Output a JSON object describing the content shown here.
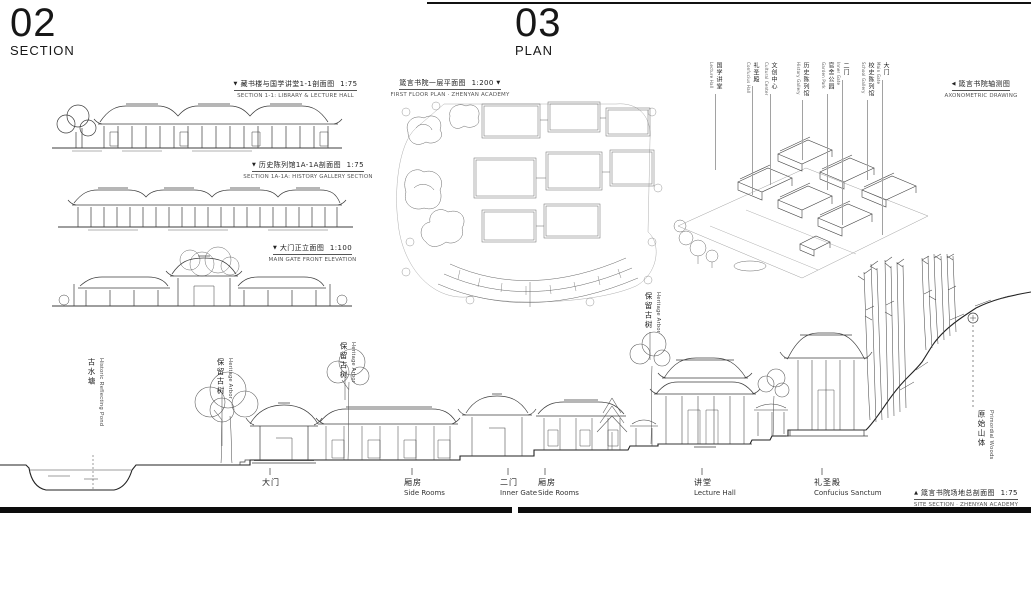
{
  "headers": {
    "section": {
      "number": "02",
      "label": "SECTION"
    },
    "plan": {
      "number": "03",
      "label": "PLAN"
    }
  },
  "markers": {
    "down": "▼",
    "left": "◀",
    "up": "▲"
  },
  "left_drawings": [
    {
      "title_zh": "藏书楼与国学讲堂1-1剖面图",
      "scale": "1:75",
      "title_en": "SECTION 1-1: LIBRARY & LECTURE HALL"
    },
    {
      "title_zh": "历史陈列馆1A-1A剖面图",
      "scale": "1:75",
      "title_en": "SECTION 1A-1A: HISTORY GALLERY SECTION"
    },
    {
      "title_zh": "大门正立面图",
      "scale": "1:100",
      "title_en": "MAIN GATE FRONT ELEVATION"
    }
  ],
  "floor_plan": {
    "title_zh": "箴言书院一层平面图",
    "scale": "1:200",
    "title_en": "FIRST FLOOR PLAN · ZHENYAN ACADEMY"
  },
  "axonometric": {
    "title_zh": "箴言书院轴测图",
    "title_en": "AXONOMETRIC DRAWING",
    "labels": [
      {
        "zh": "国学讲堂",
        "en": "Lecture Hall"
      },
      {
        "zh": "礼圣殿",
        "en": "Confucius Hall"
      },
      {
        "zh": "文创中心",
        "en": "Cultural Center"
      },
      {
        "zh": "历史陈列馆",
        "en": "History Gallery"
      },
      {
        "zh": "官舍公园",
        "en": "Garden Park"
      },
      {
        "zh": "二门",
        "en": "Inner Gate"
      },
      {
        "zh": "校史陈列馆",
        "en": "School Gallery"
      },
      {
        "zh": "大门",
        "en": "Main Gate"
      }
    ]
  },
  "site_section": {
    "tree_labels": [
      {
        "zh": "古水塘",
        "en": "Historic Reflecting Pond"
      },
      {
        "zh": "保留古树",
        "en": "Heritage Arbor"
      },
      {
        "zh": "保留古树",
        "en": "Heritage Arbor"
      },
      {
        "zh": "保留古树",
        "en": "Heritage Arbor"
      },
      {
        "zh": "原始山体",
        "en": "Primordial Woods"
      }
    ],
    "building_labels": [
      {
        "zh": "大门",
        "en": ""
      },
      {
        "zh": "厢房",
        "en": "Side Rooms"
      },
      {
        "zh": "二门",
        "en": "Inner Gate"
      },
      {
        "zh": "厢房",
        "en": "Side Rooms"
      },
      {
        "zh": "讲堂",
        "en": "Lecture Hall"
      },
      {
        "zh": "礼圣殿",
        "en": "Confucius Sanctum"
      }
    ],
    "caption": {
      "title_zh": "箴言书院场地总剖面图",
      "scale": "1:75",
      "title_en": "SITE SECTION · ZHENYAN ACADEMY"
    }
  },
  "colors": {
    "ink": "#1b1b1b",
    "line": "#3d3d3d",
    "light_line": "#777777"
  }
}
